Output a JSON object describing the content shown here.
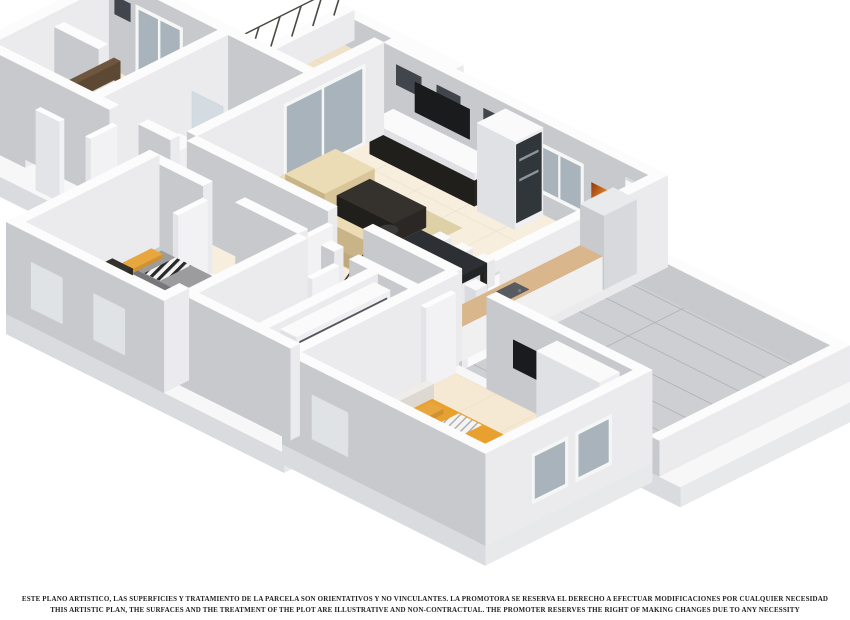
{
  "scene": {
    "type": "3d-isometric-floor-plan",
    "rooms": [
      {
        "name": "living-dining-room"
      },
      {
        "name": "kitchen"
      },
      {
        "name": "master-bedroom-west"
      },
      {
        "name": "bathroom-ensuite"
      },
      {
        "name": "twin-bedroom"
      },
      {
        "name": "bathroom-2"
      },
      {
        "name": "wardrobe-corridor"
      },
      {
        "name": "master-bedroom-south"
      },
      {
        "name": "terrace-northwest"
      },
      {
        "name": "terrace-east"
      },
      {
        "name": "staircase"
      },
      {
        "name": "hallway"
      }
    ],
    "furniture": [
      {
        "name": "tv-wall-unit"
      },
      {
        "name": "bookcase"
      },
      {
        "name": "corner-sofa"
      },
      {
        "name": "coffee-table"
      },
      {
        "name": "dining-table"
      },
      {
        "name": "dining-chairs"
      },
      {
        "name": "arc-floor-lamp"
      },
      {
        "name": "kitchen-counter"
      },
      {
        "name": "fridge"
      },
      {
        "name": "double-bed-brown"
      },
      {
        "name": "twin-beds"
      },
      {
        "name": "double-bed-orange"
      },
      {
        "name": "wall-painting"
      },
      {
        "name": "wardrobes"
      },
      {
        "name": "shower"
      },
      {
        "name": "washbasin"
      },
      {
        "name": "toilet"
      }
    ]
  },
  "colors": {
    "background": "#ffffff",
    "wall_top": "#fcfcfc",
    "wall_light": "#ebebee",
    "wall_shade": "#c7c9cd",
    "floor_cream": "#f7eedd",
    "floor_bedroom": "#f6e9d3",
    "floor_bath": "#e9dcc2",
    "floor_bath2": "#c0c2c6",
    "floor_wood": "#c69b63",
    "floor_terrace_nw": "#f0e2c8",
    "floor_terrace_e": "#cdcfd2",
    "rug_living": "#ded1a8",
    "rug_dark": "#474c54",
    "rug_master": "#4e535b",
    "sofa_beige": "#e3cfa8",
    "furniture_dark": "#35312d",
    "tv_black": "#1a1b1d",
    "bed_brown": "#c3a17d",
    "duvet_gray": "#9c9c9e",
    "bed_orange": "#e8a12f",
    "pillow_yellow": "#e8a63e",
    "counter_wood": "#d9b68c",
    "glass_blue": "#a9b3bb",
    "painting_orange": "#c9651f",
    "text": "#1f1f1f"
  },
  "disclaimer": {
    "line1": "ESTE PLANO ARTISTICO, LAS SUPERFICIES Y TRATAMIENTO DE LA PARCELA SON ORIENTATIVOS Y NO VINCULANTES. LA PROMOTORA SE RESERVA EL DERECHO A EFECTUAR MODIFICACIONES POR CUALQUIER NECESIDAD",
    "line2": "THIS ARTISTIC PLAN, THE SURFACES AND THE TREATMENT OF THE PLOT ARE ILLUSTRATIVE AND NON-CONTRACTUAL. THE PROMOTER RESERVES THE RIGHT OF MAKING CHANGES DUE TO ANY NECESSITY"
  }
}
